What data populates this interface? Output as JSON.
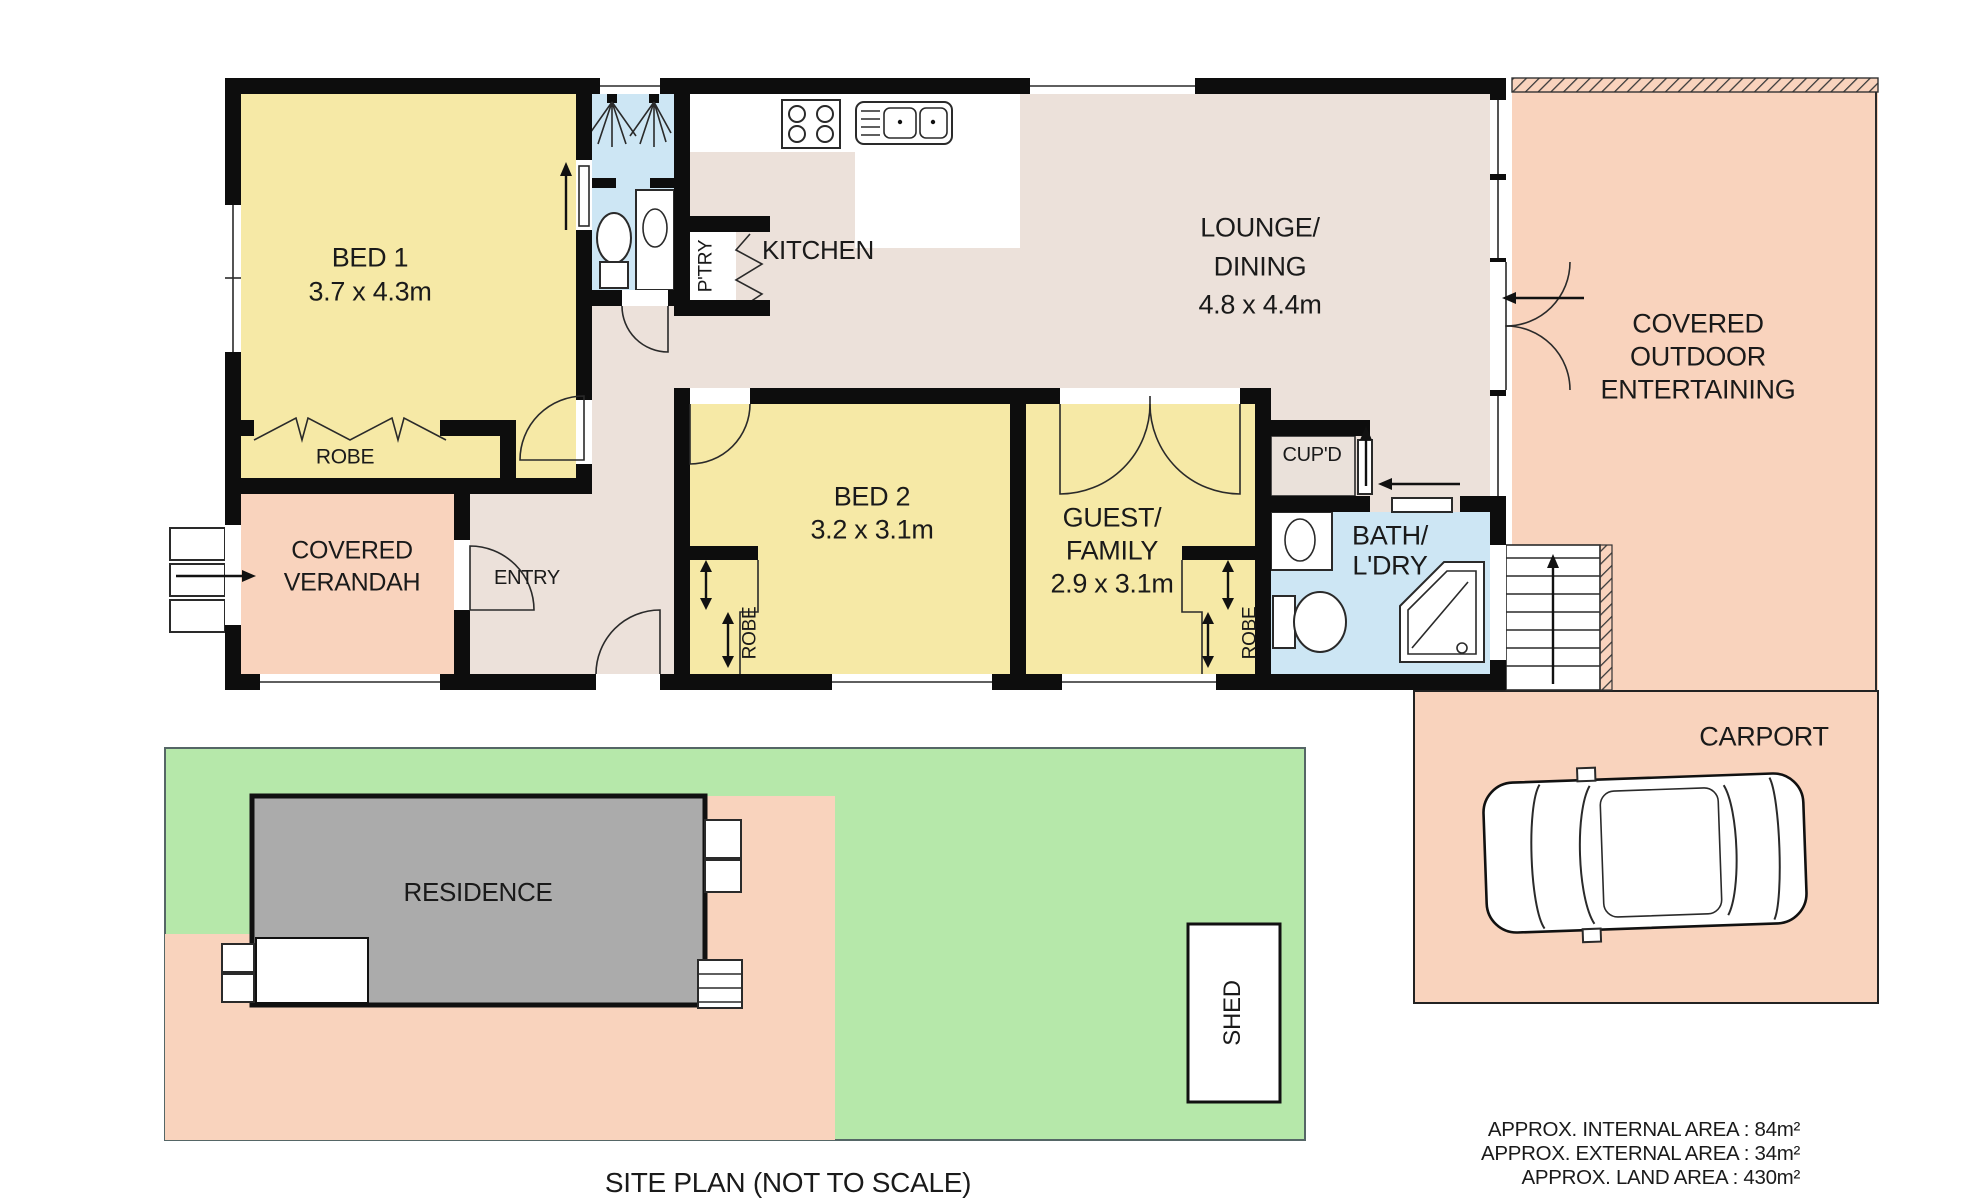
{
  "colors": {
    "wall": "#0d0d0d",
    "yellow": "#f6e9a6",
    "beige": "#ece1da",
    "blue": "#cde6f4",
    "salmon": "#f9d3bd",
    "green": "#b6e8aa",
    "gray": "#ababab",
    "text": "#1a1a1a"
  },
  "floor_plan": {
    "bed1": {
      "name": "BED 1",
      "dims": "3.7 x 4.3m",
      "robe": "ROBE"
    },
    "pantry": "P'TRY",
    "kitchen": "KITCHEN",
    "lounge": {
      "name1": "LOUNGE/",
      "name2": "DINING",
      "dims": "4.8 x 4.4m"
    },
    "outdoor": {
      "name1": "COVERED",
      "name2": "OUTDOOR",
      "name3": "ENTERTAINING"
    },
    "verandah": {
      "name1": "COVERED",
      "name2": "VERANDAH"
    },
    "entry": "ENTRY",
    "bed2": {
      "name": "BED 2",
      "dims": "3.2 x 3.1m",
      "robe": "ROBE"
    },
    "guest": {
      "name1": "GUEST/",
      "name2": "FAMILY",
      "dims": "2.9 x 3.1m",
      "robe": "ROBE"
    },
    "cupboard": "CUP'D",
    "bath": {
      "name1": "BATH/",
      "name2": "L'DRY"
    },
    "carport": "CARPORT"
  },
  "site_plan": {
    "residence": "RESIDENCE",
    "shed": "SHED",
    "caption": "SITE PLAN (NOT TO SCALE)"
  },
  "areas": {
    "internal": "APPROX. INTERNAL AREA : 84m²",
    "external": "APPROX. EXTERNAL AREA : 34m²",
    "land": "APPROX. LAND AREA : 430m²"
  }
}
